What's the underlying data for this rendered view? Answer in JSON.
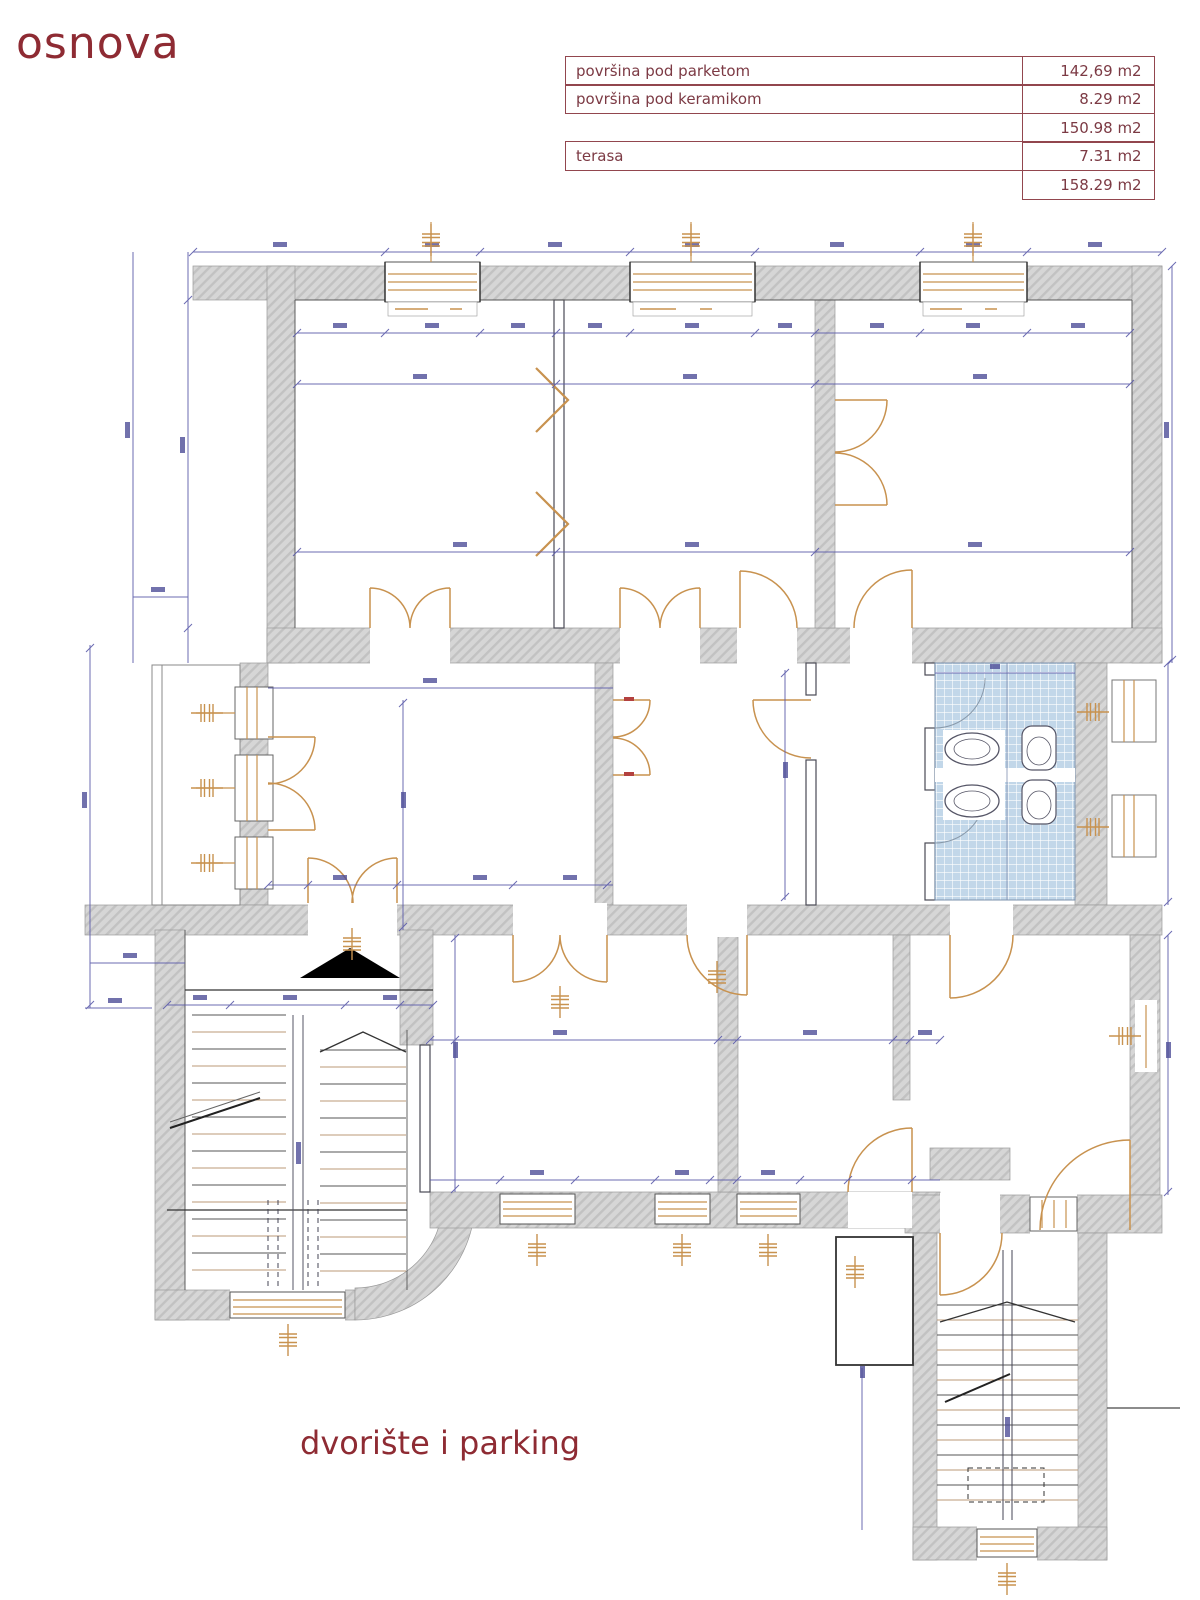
{
  "title": "osnova",
  "caption": "dvorište i parking",
  "area_table": {
    "rows": [
      {
        "label": "površina pod parketom",
        "value": "142,69 m2"
      },
      {
        "label": "površina pod keramikom",
        "value": "8.29 m2"
      },
      {
        "label": "",
        "value": "150.98 m2"
      },
      {
        "label": "terasa",
        "value": "7.31 m2"
      },
      {
        "label": "",
        "value": "158.29 m2"
      }
    ]
  },
  "colors": {
    "accent_red": "#8e2b33",
    "wall_gray": "#d6d6d6",
    "dimension_blue": "#5b5baa",
    "joinery_orange": "#c8924f",
    "tile_blue": "#c2d7e9"
  }
}
